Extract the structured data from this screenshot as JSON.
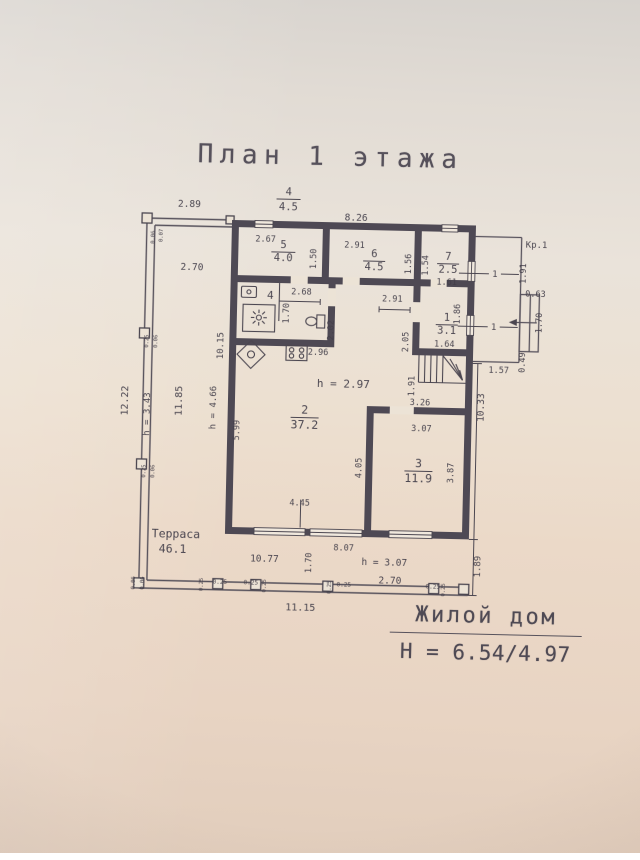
{
  "title": "План 1 этажа",
  "footer": {
    "building": "Жилой дом",
    "heights": "H = 6.54/4.97"
  },
  "colors": {
    "ink": "#4b4650",
    "wall": "#4e4954",
    "label": "#413d48",
    "paper": "#ece3d6"
  },
  "plan": {
    "rooms": [
      {
        "number": "1",
        "area": "3.1"
      },
      {
        "number": "2",
        "area": "37.2",
        "ceiling_height": "h = 2.97"
      },
      {
        "number": "3",
        "area": "11.9"
      },
      {
        "number": "4",
        "area": "4.5"
      },
      {
        "number": "5",
        "area": "4.0"
      },
      {
        "number": "6",
        "area": "4.5"
      },
      {
        "number": "7",
        "area": "2.5"
      }
    ],
    "terrace": {
      "name": "Терраса",
      "area": "46.1"
    },
    "porch": {
      "name": "Кр.1"
    },
    "overall": {
      "width": "11.15",
      "height": "12.22"
    }
  },
  "labels": [
    {
      "t": "2.89",
      "x": 185,
      "y": 210,
      "s": 9.5
    },
    {
      "t": "4",
      "x": 284,
      "y": 196,
      "s": 10.5,
      "n": "room-4-ref-number"
    },
    {
      "t": "4.5",
      "x": 284,
      "y": 211,
      "s": 10.5,
      "n": "room-4-ref-area"
    },
    {
      "t": "8.26",
      "x": 352,
      "y": 220,
      "s": 9.5
    },
    {
      "t": "Кр.1",
      "x": 533,
      "y": 243,
      "s": 9,
      "n": "porch-label"
    },
    {
      "t": "0.06",
      "x": 151,
      "y": 241,
      "r": -90,
      "s": 5.5
    },
    {
      "t": "0.07",
      "x": 159,
      "y": 239,
      "r": -90,
      "s": 5.5
    },
    {
      "t": "2.70",
      "x": 189,
      "y": 273,
      "s": 9.5
    },
    {
      "t": "2.67",
      "x": 262,
      "y": 243
    },
    {
      "t": "5",
      "x": 280,
      "y": 249,
      "s": 10.5,
      "n": "room-5-number"
    },
    {
      "t": "4.0",
      "x": 280,
      "y": 262,
      "s": 10.5,
      "n": "room-5-area"
    },
    {
      "t": "1.50",
      "x": 313,
      "y": 259,
      "r": -90
    },
    {
      "t": "2.91",
      "x": 351,
      "y": 247
    },
    {
      "t": "6",
      "x": 371,
      "y": 256,
      "s": 10.5,
      "n": "room-6-number"
    },
    {
      "t": "4.5",
      "x": 371,
      "y": 269,
      "s": 10.5,
      "n": "room-6-area"
    },
    {
      "t": "1.56",
      "x": 408,
      "y": 262,
      "r": -90
    },
    {
      "t": "1.54",
      "x": 425,
      "y": 263,
      "r": -90
    },
    {
      "t": "7",
      "x": 445,
      "y": 257,
      "s": 10.5,
      "n": "room-7-number"
    },
    {
      "t": "2.5",
      "x": 445,
      "y": 270,
      "s": 10.5,
      "n": "room-7-area"
    },
    {
      "t": "1.61",
      "x": 444,
      "y": 282
    },
    {
      "t": "1.91",
      "x": 523,
      "y": 269,
      "r": -90
    },
    {
      "t": "0.63",
      "x": 533,
      "y": 292
    },
    {
      "t": "2.68",
      "x": 299,
      "y": 295
    },
    {
      "t": "4",
      "x": 268,
      "y": 300,
      "s": 11,
      "n": "room-4-marker"
    },
    {
      "t": "1.70",
      "x": 287,
      "y": 314,
      "r": -90
    },
    {
      "t": "2.91",
      "x": 390,
      "y": 300
    },
    {
      "t": "1.86",
      "x": 458,
      "y": 311,
      "r": -90
    },
    {
      "t": "1",
      "x": 492,
      "y": 273,
      "s": 9,
      "n": "opening-marker-1"
    },
    {
      "t": "1",
      "x": 445,
      "y": 318,
      "s": 10.5,
      "n": "room-1-number"
    },
    {
      "t": "3.1",
      "x": 445,
      "y": 331,
      "s": 10.5,
      "n": "room-1-area"
    },
    {
      "t": "1",
      "x": 492,
      "y": 326,
      "s": 9,
      "n": "opening-marker-2"
    },
    {
      "t": "2.05",
      "x": 407,
      "y": 340,
      "r": -90
    },
    {
      "t": "2.02",
      "x": 332,
      "y": 330,
      "r": -90
    },
    {
      "t": "1.64",
      "x": 443,
      "y": 344
    },
    {
      "t": "1.70",
      "x": 540,
      "y": 318,
      "r": -90
    },
    {
      "t": "0.49",
      "x": 524,
      "y": 358,
      "r": -90
    },
    {
      "t": "1.57",
      "x": 498,
      "y": 369
    },
    {
      "t": "2.96",
      "x": 317,
      "y": 355
    },
    {
      "t": "1.91",
      "x": 414,
      "y": 384,
      "r": -90
    },
    {
      "t": "10.15",
      "x": 222,
      "y": 348,
      "r": -90,
      "s": 9
    },
    {
      "t": "h = 4.66",
      "x": 216,
      "y": 410,
      "r": -90,
      "s": 9
    },
    {
      "t": "5.99",
      "x": 240,
      "y": 432,
      "r": -90
    },
    {
      "t": "11.85",
      "x": 182,
      "y": 404,
      "r": -90,
      "s": 10
    },
    {
      "t": "h = 3.43",
      "x": 150,
      "y": 418,
      "r": -90,
      "s": 9
    },
    {
      "t": "12.22",
      "x": 128,
      "y": 405,
      "r": -90,
      "s": 10
    },
    {
      "t": "h = 2.97",
      "x": 343,
      "y": 387,
      "s": 11,
      "n": "ceiling-height-note"
    },
    {
      "t": "2",
      "x": 305,
      "y": 414,
      "s": 11.5,
      "n": "room-2-number"
    },
    {
      "t": "37.2",
      "x": 305,
      "y": 429,
      "s": 11.5,
      "n": "room-2-area"
    },
    {
      "t": "3.26",
      "x": 420,
      "y": 403
    },
    {
      "t": "3.07",
      "x": 422,
      "y": 429
    },
    {
      "t": "10.33",
      "x": 484,
      "y": 404,
      "r": -90,
      "s": 9.5
    },
    {
      "t": "4.05",
      "x": 363,
      "y": 467,
      "r": -90
    },
    {
      "t": "3",
      "x": 420,
      "y": 465,
      "s": 11.5,
      "n": "room-3-number"
    },
    {
      "t": "11.9",
      "x": 420,
      "y": 480,
      "s": 11.5,
      "n": "room-3-area"
    },
    {
      "t": "3.87",
      "x": 455,
      "y": 470,
      "r": -90
    },
    {
      "t": "4.45",
      "x": 302,
      "y": 506
    },
    {
      "t": "Терраса",
      "x": 179,
      "y": 541,
      "s": 11.5,
      "n": "terrace-name"
    },
    {
      "t": "46.1",
      "x": 176,
      "y": 556,
      "s": 11.5,
      "n": "terrace-area"
    },
    {
      "t": "8.07",
      "x": 347,
      "y": 550
    },
    {
      "t": "10.77",
      "x": 268,
      "y": 563,
      "s": 9.5
    },
    {
      "t": "1.70",
      "x": 315,
      "y": 563,
      "r": -90
    },
    {
      "t": "h = 3.07",
      "x": 388,
      "y": 564,
      "s": 9.5
    },
    {
      "t": "2.70",
      "x": 394,
      "y": 582,
      "s": 9.5
    },
    {
      "t": "1.89",
      "x": 484,
      "y": 563,
      "r": -90,
      "s": 9
    },
    {
      "t": "11.15",
      "x": 305,
      "y": 611,
      "s": 10
    },
    {
      "t": "0.06",
      "x": 139,
      "y": 587,
      "r": -90,
      "s": 5.5
    },
    {
      "t": "0.06",
      "x": 148,
      "y": 587,
      "r": -90,
      "s": 5.5
    },
    {
      "t": "0.25",
      "x": 207,
      "y": 587,
      "r": -90,
      "s": 5.5
    },
    {
      "t": "0.25",
      "x": 224,
      "y": 586,
      "s": 6
    },
    {
      "t": "0.25",
      "x": 255,
      "y": 586,
      "s": 6
    },
    {
      "t": "0.25",
      "x": 270,
      "y": 587,
      "r": -90,
      "s": 5.5
    },
    {
      "t": "0.25",
      "x": 335,
      "y": 587,
      "r": -90,
      "s": 5.5
    },
    {
      "t": "0.25",
      "x": 348,
      "y": 586,
      "s": 6
    },
    {
      "t": "0.25",
      "x": 437,
      "y": 586,
      "s": 6
    },
    {
      "t": "0.25",
      "x": 449,
      "y": 587,
      "r": -90,
      "s": 5.5
    },
    {
      "t": "0.25",
      "x": 147,
      "y": 345,
      "r": -90,
      "s": 5.5
    },
    {
      "t": "0.06",
      "x": 156,
      "y": 345,
      "r": -90,
      "s": 5.5
    },
    {
      "t": "0.25",
      "x": 147,
      "y": 475,
      "r": -90,
      "s": 5.5
    },
    {
      "t": "0.06",
      "x": 156,
      "y": 475,
      "r": -90,
      "s": 5.5
    }
  ]
}
